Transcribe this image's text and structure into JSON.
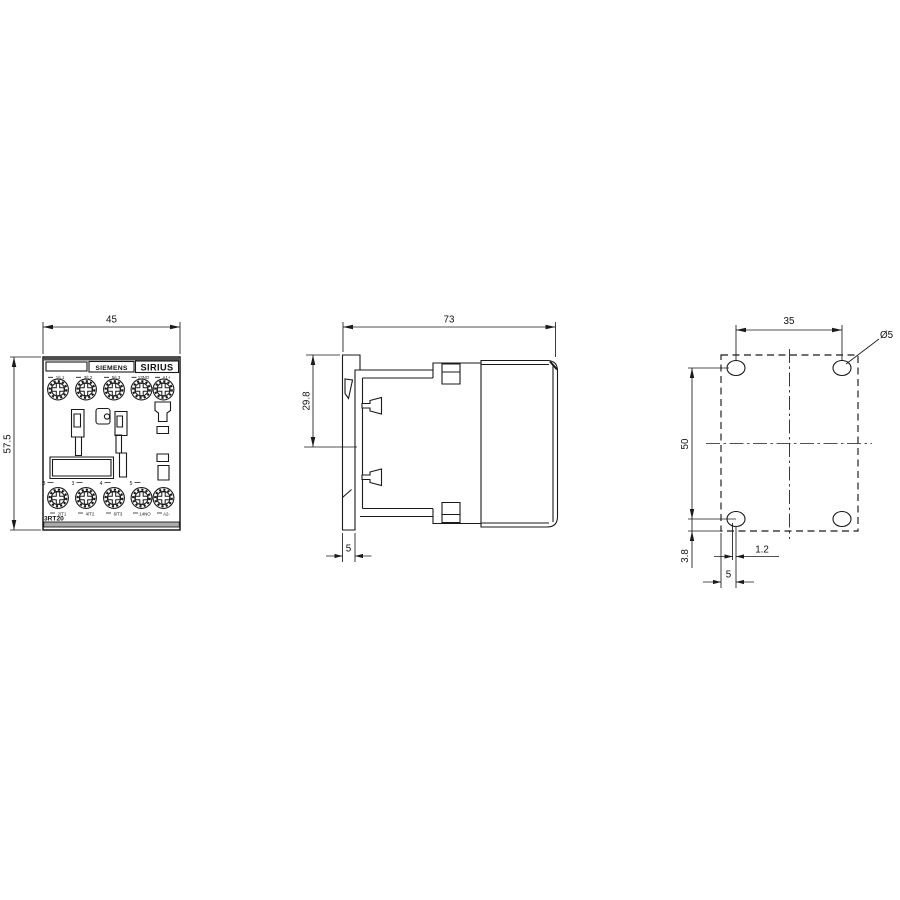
{
  "front_view": {
    "brand": "SIEMENS",
    "series": "SIRIUS",
    "model": "3RT20",
    "dim_width": "45",
    "dim_height": "57.5",
    "top_terminals": [
      "1/L1",
      "3/L2",
      "5/L3",
      "13NO",
      "A1+"
    ],
    "bottom_terminals": [
      "2/T1",
      "4/T2",
      "6/T3",
      "14NO",
      "A2-"
    ],
    "molded_numbers": [
      "8",
      "3",
      "4",
      "5"
    ]
  },
  "side_view": {
    "dim_depth": "73",
    "dim_rail_top_offset": "29.8",
    "dim_rail_thickness": "5"
  },
  "drill_plan": {
    "dim_hole_spacing_horizontal": "35",
    "dim_hole_spacing_vertical": "50",
    "hole_diameter": "Ø5",
    "dim_bottom_edge_offset": "3.8",
    "dim_slot_offset": "1.2",
    "dim_left_edge_offset": "5"
  }
}
